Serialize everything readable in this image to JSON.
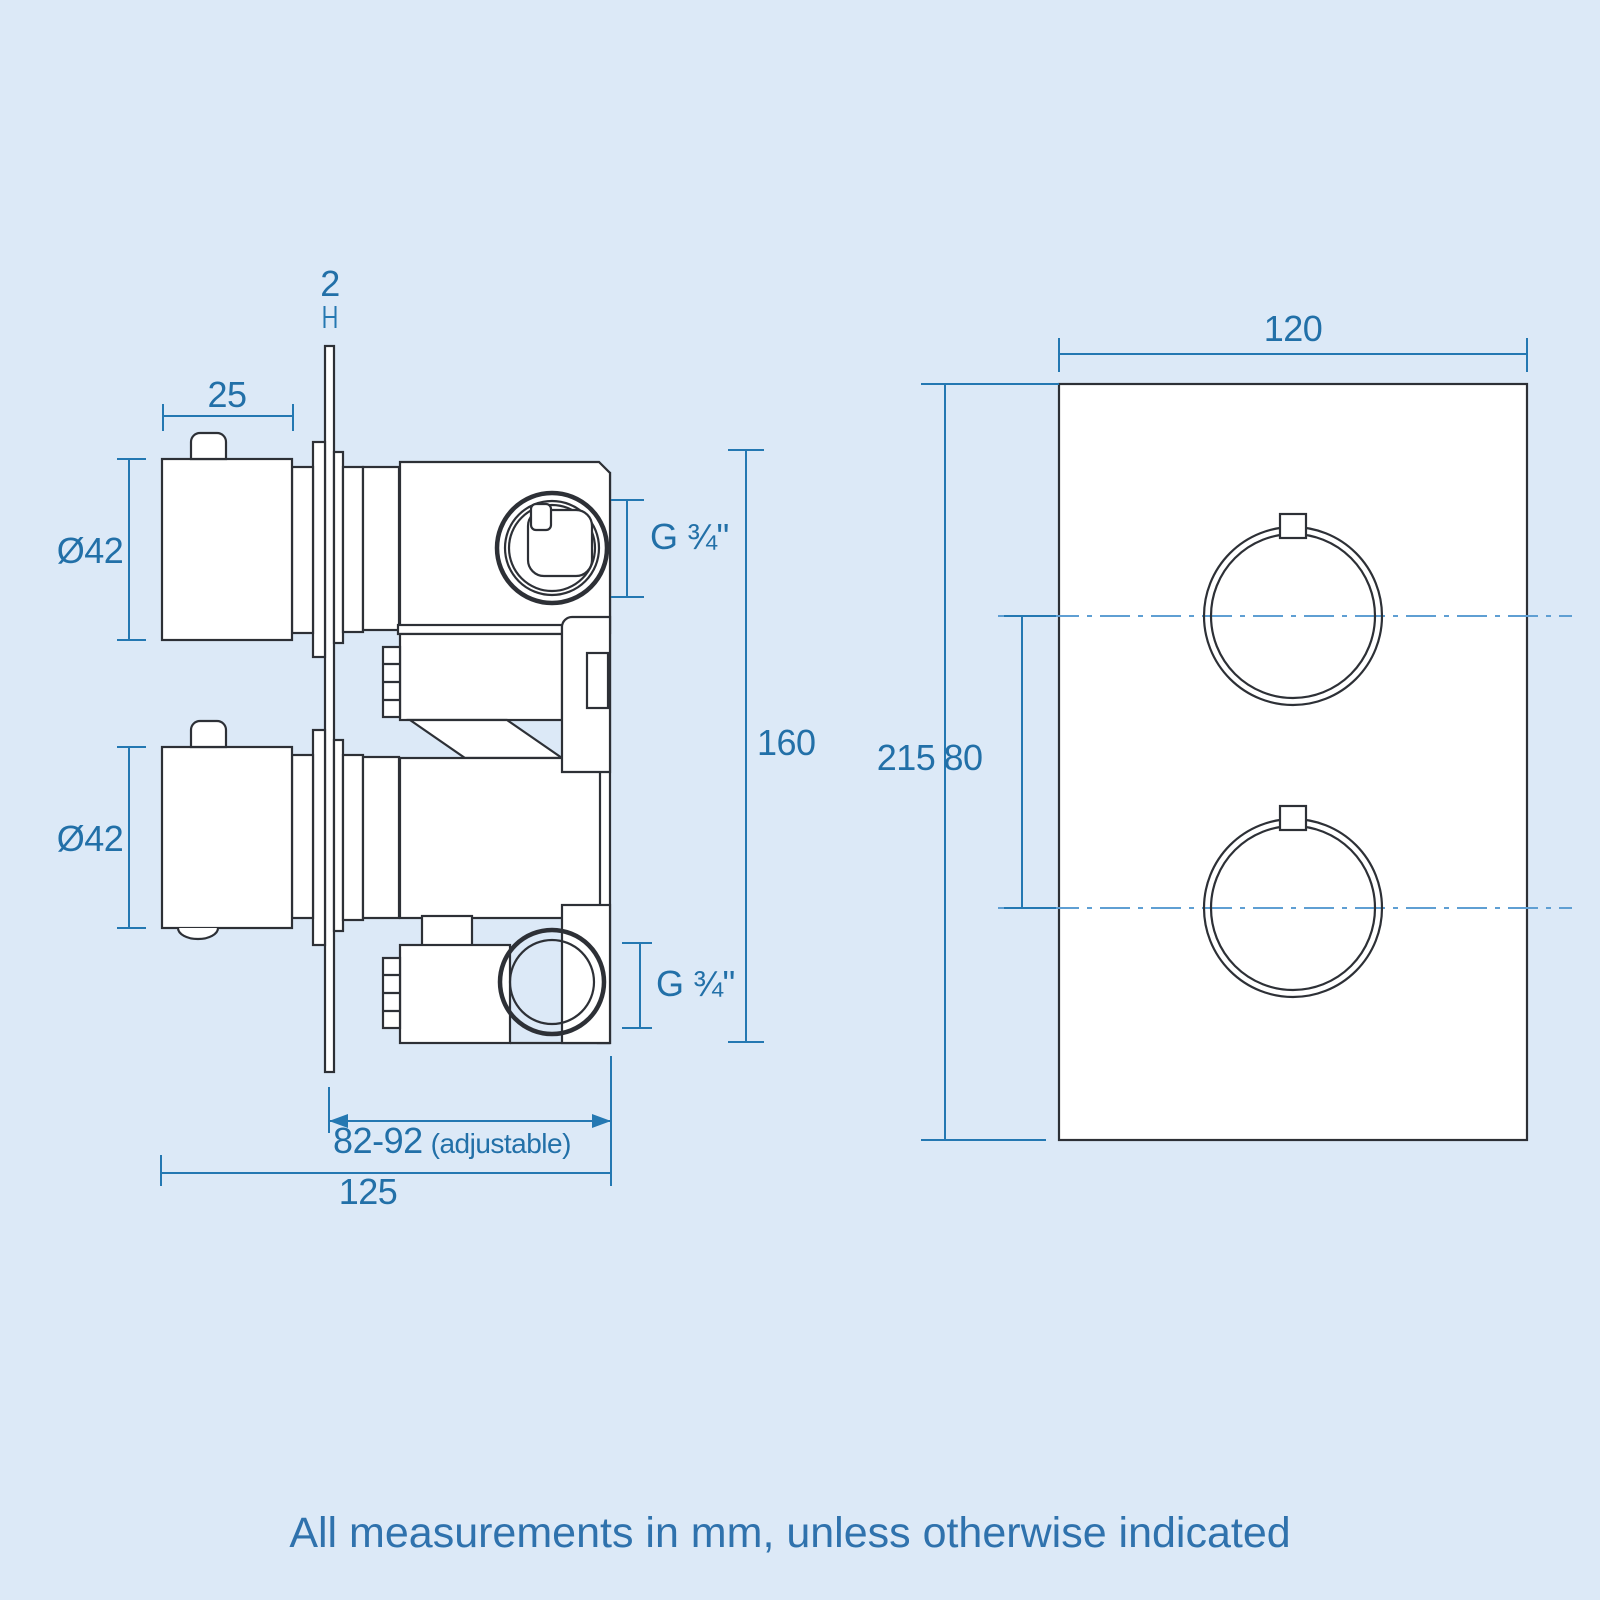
{
  "colors": {
    "background": "#dce9f7",
    "line_art": "#2d3036",
    "dimension_lines": "#2478b2",
    "dimension_text": "#2270a8",
    "centerline": "#5f9fd3",
    "note_text": "#2f72ad"
  },
  "side_view": {
    "plate_thickness": "2",
    "knob_width": "25",
    "knob_diameter_top": "Ø42",
    "knob_diameter_bottom": "Ø42",
    "port_top": "G ¾\"",
    "port_bottom": "G ¾\"",
    "valve_height": "160",
    "depth_value": "82-92",
    "depth_note": "(adjustable)",
    "overall_depth": "125"
  },
  "front_view": {
    "plate_width": "120",
    "plate_height": "215",
    "handle_spacing": "80"
  },
  "footer": {
    "note": "All measurements in mm, unless otherwise indicated"
  }
}
